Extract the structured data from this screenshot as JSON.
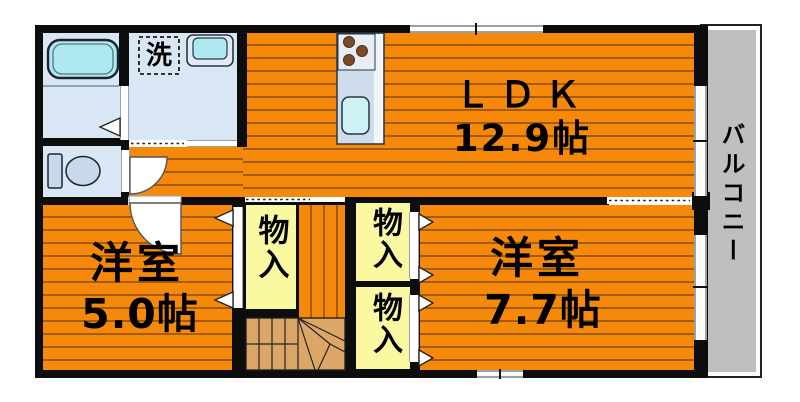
{
  "plan_title": "apartment-floor-plan",
  "rooms": {
    "ldk": {
      "label": "ＬＤＫ",
      "area": "12.9帖"
    },
    "bedroom_left": {
      "label": "洋室",
      "area": "5.0帖"
    },
    "bedroom_right": {
      "label": "洋室",
      "area": "7.7帖"
    },
    "balcony": {
      "label": "バルコニー"
    },
    "closet": {
      "label": "物入"
    },
    "laundry_machine": {
      "label": "洗"
    }
  },
  "colors": {
    "floor_orange": "#F6890A",
    "plank_line": "#A35C06",
    "wall_black": "#0D0D0D",
    "sanitary_blue": "#D9E7F4",
    "water_cyan": "#AEE9F1",
    "closet_yellow": "#FAF8A0",
    "balcony_gray": "#BFBFBF",
    "stair_tan": "#DCA766",
    "fixture_blue": "#CFDCEB",
    "fixture_light": "#E8EEF5",
    "burner_brown": "#7B4A28"
  }
}
